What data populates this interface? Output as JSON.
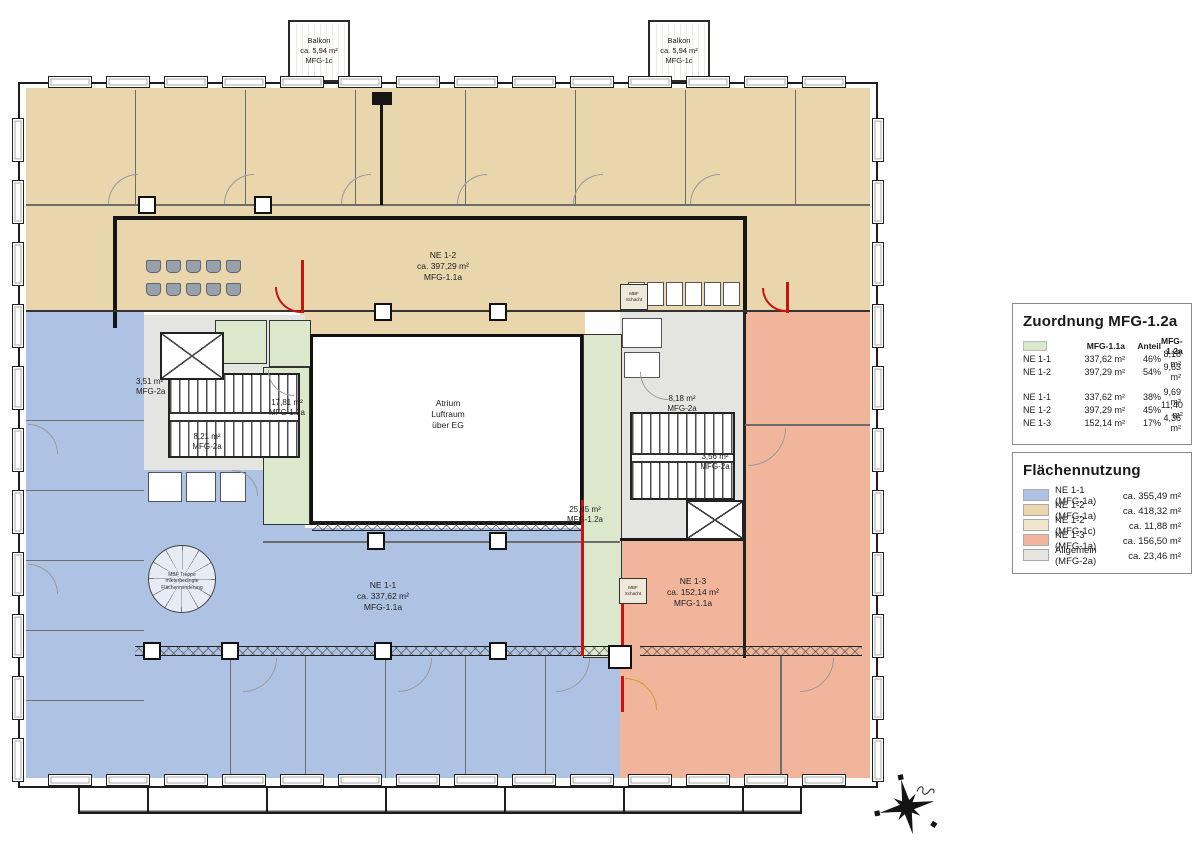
{
  "colors": {
    "tan": "#e9d6ad",
    "tan_light": "#f0e6cd",
    "blue": "#aec3e3",
    "salmon": "#f1b59c",
    "green": "#dce8cb",
    "gray": "#e4e4e0",
    "red": "#cc1111"
  },
  "plan": {
    "balcony": {
      "text": "Balkon\nca. 5,94 m²\nMFG-1c"
    },
    "rooms": {
      "ne12": "NE 1-2\nca. 397,29 m²\nMFG-1.1a",
      "ne11": "NE 1-1\nca. 337,62 m²\nMFG-1.1a",
      "ne13": "NE 1-3\nca. 152,14 m²\nMFG-1.1a",
      "atrium": "Atrium\nLuftraum\nüber EG"
    },
    "areas": {
      "a351": "3,51 m²\nMFG-2a",
      "a1781": "17,81 m²\nMFG-1.2a",
      "a821": "8,21 m²\nMFG-2a",
      "a818": "8,18 m²\nMFG-2a",
      "a356": "3,56 m²\nMFG-2a",
      "a2545": "25,45 m²\nMFG-1.2a"
    },
    "notes": {
      "mbf_treppe": "MBF Treppe\nmieterbedingte\nFlächenminderung",
      "mbf_schacht": "MBF\nSchacht"
    }
  },
  "legend_zuordnung": {
    "title": "Zuordnung MFG-1.2a",
    "header": {
      "col1": "MFG-1.1a",
      "col2": "Anteil",
      "col3": "MFG-1.2a"
    },
    "group1": [
      {
        "name": "NE 1-1",
        "area": "337,62 m²",
        "anteil": "46%",
        "value": "8,18 m²"
      },
      {
        "name": "NE 1-2",
        "area": "397,29 m²",
        "anteil": "54%",
        "value": "9,63 m²"
      }
    ],
    "group2": [
      {
        "name": "NE 1-1",
        "area": "337,62 m²",
        "anteil": "38%",
        "value": "9,69 m²"
      },
      {
        "name": "NE 1-2",
        "area": "397,29 m²",
        "anteil": "45%",
        "value": "11,40 m²"
      },
      {
        "name": "NE 1-3",
        "area": "152,14 m²",
        "anteil": "17%",
        "value": "4,36 m²"
      }
    ]
  },
  "legend_flaeche": {
    "title": "Flächennutzung",
    "items": [
      {
        "label": "NE 1-1 (MFG-1a)",
        "value": "ca. 355,49 m²",
        "color": "#aec3e3"
      },
      {
        "label": "NE 1-2 (MFG-1a)",
        "value": "ca. 418,32 m²",
        "color": "#e9d6ad"
      },
      {
        "label": "NE 1-2 (MFG-1c)",
        "value": "ca. 11,88 m²",
        "color": "#f0e6cd"
      },
      {
        "label": "NE 1-3 (MFG-1a)",
        "value": "ca. 156,50 m²",
        "color": "#f1b59c"
      },
      {
        "label": "Allgemein (MFG-2a)",
        "value": "ca. 23,46 m²",
        "color": "#e4e4e0"
      }
    ]
  }
}
